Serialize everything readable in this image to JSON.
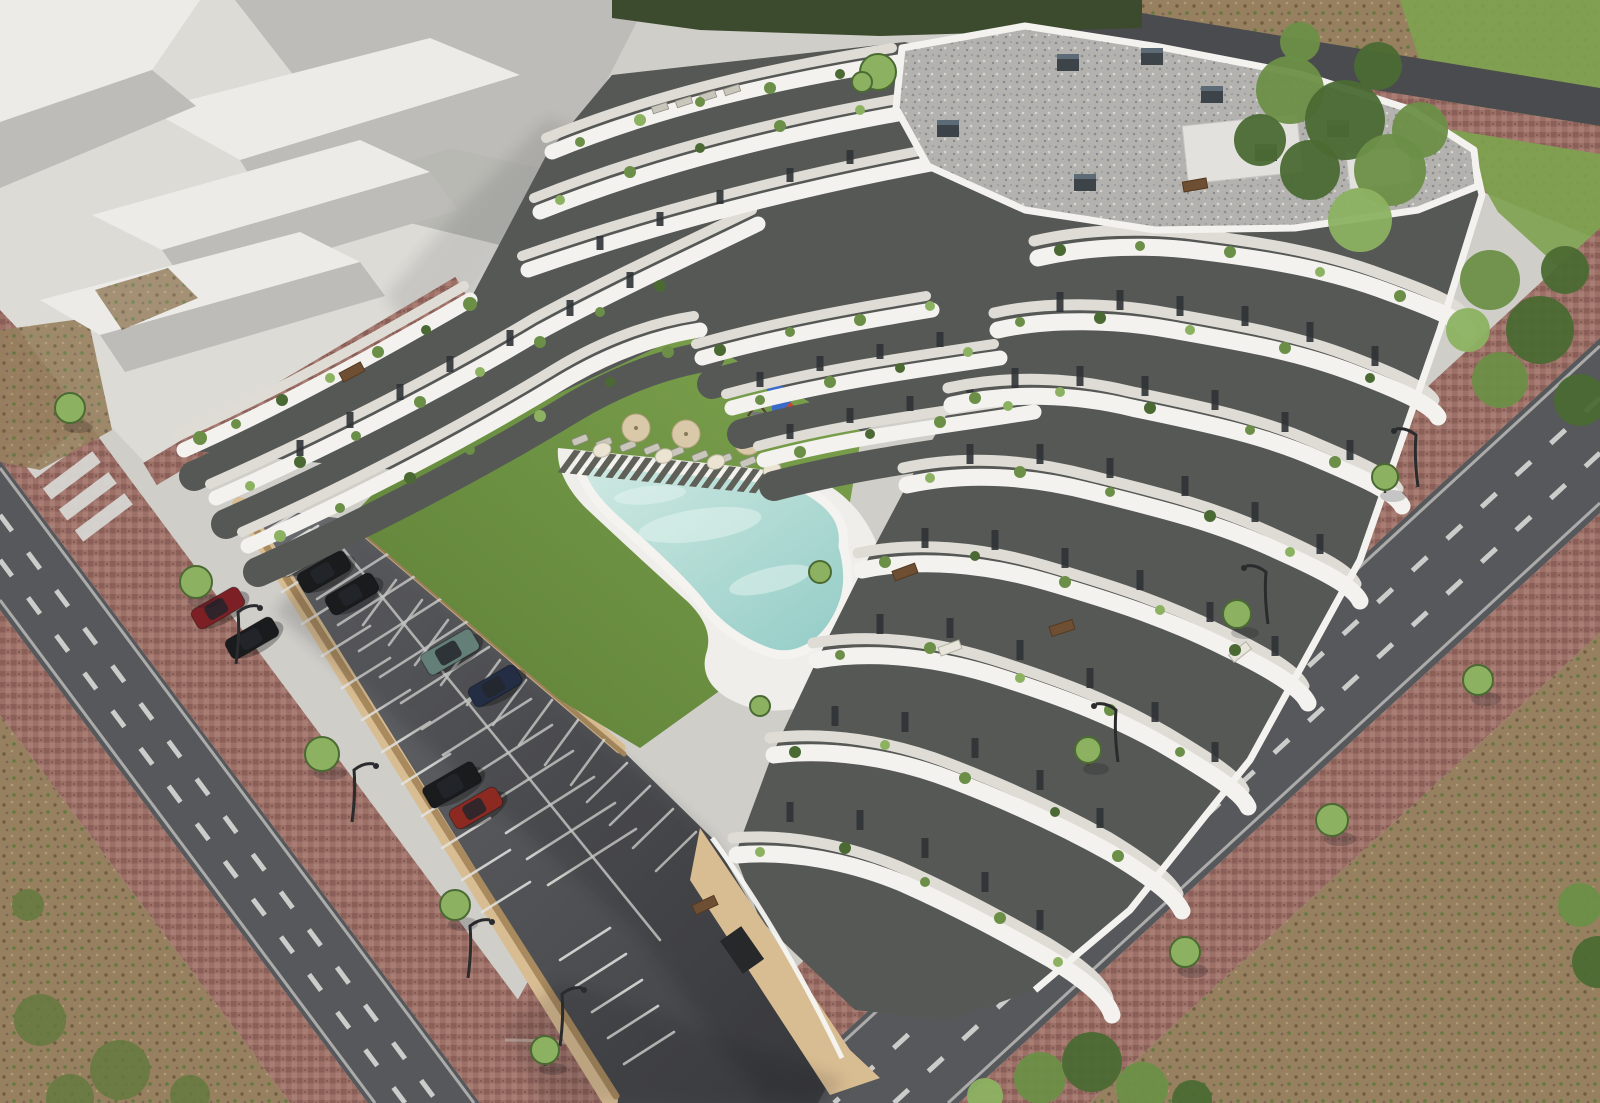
{
  "meta": {
    "image_type": "3d-architectural-rendering",
    "view": "aerial-oblique",
    "description": "Aerial render of a modern white terraced apartment complex with wavy balcony bands, gravel flat roof, inner courtyard lawn with free-form pool, sun deck, playground, gated parking lot with cars, perimeter roads with red paver sidewalks, vacant dirt lots and neighbouring massing blocks."
  },
  "palette": {
    "concrete": "#cfcec9",
    "concrete-bright": "#dcdbd6",
    "block-top": "#ecebe8",
    "block-side": "#bdbcb8",
    "block-dark": "#a2a19d",
    "road": "#57585b",
    "road-dark": "#4a4b4e",
    "lane": "#d9d9d6",
    "parking-light": "#6a6b6e",
    "parking-dark": "#3e3f42",
    "paver": "#9c7067",
    "paver-dark": "#7c564f",
    "dirt": "#97805f",
    "dirt-dark": "#6f5c42",
    "weed": "#64793f",
    "grass": "#7da24f",
    "lawn-light": "#7ca24d",
    "lawn-dark": "#5d7f37",
    "pool-light": "#cfe9e2",
    "pool-deep": "#93ccc6",
    "deck-wood": "#5f6058",
    "bldg-white": "#f3f2ef",
    "bldg-shade": "#e2e1dd",
    "floor": "#dedcd5",
    "recess": "#565856",
    "window": "#303336",
    "wall-tan": "#d9bd92",
    "wall-tan-dark": "#a98a5e",
    "roof-gravel": "#b3b2ae",
    "hedge": "#3c4a2e",
    "tree": "#6b8f47",
    "tree-light": "#8cb261",
    "tree-dark": "#4b6a33",
    "car-silver": "#b9bbbd",
    "car-black": "#1a1b1d",
    "car-maroon": "#7c2026",
    "car-teal": "#647f77",
    "car-blue": "#232e45",
    "car-darkred": "#8c2a22",
    "play-blue": "#3a6bc9",
    "play-red": "#bf4a38",
    "umb-cream": "#ebe4d3",
    "umb-tan": "#d9c9a8",
    "furn": "#c9c6bc",
    "lamp": "#2a2b2d",
    "rail": "#f6f5f2"
  },
  "scene": {
    "areas": [
      "apartment-building",
      "gravel-roof",
      "terraced-balconies",
      "courtyard-lawn",
      "swimming-pool",
      "pool-deck",
      "playground",
      "parking-lot",
      "access-roads",
      "zebra-crossing",
      "red-paver-sidewalks",
      "vacant-dirt-lots",
      "neighbouring-massing-blocks",
      "street-trees"
    ],
    "counts": {
      "cars": 9,
      "tan_parasols": 3,
      "cream_umbrellas": 4,
      "sun_loungers": 14,
      "street_lamps": 7,
      "sidewalk_trees": 11,
      "large_trees": 4,
      "rooftop_chimneys": 7
    },
    "car_colors": [
      "silver",
      "black",
      "black",
      "maroon",
      "black",
      "teal",
      "dark-blue",
      "black",
      "dark-red"
    ]
  }
}
